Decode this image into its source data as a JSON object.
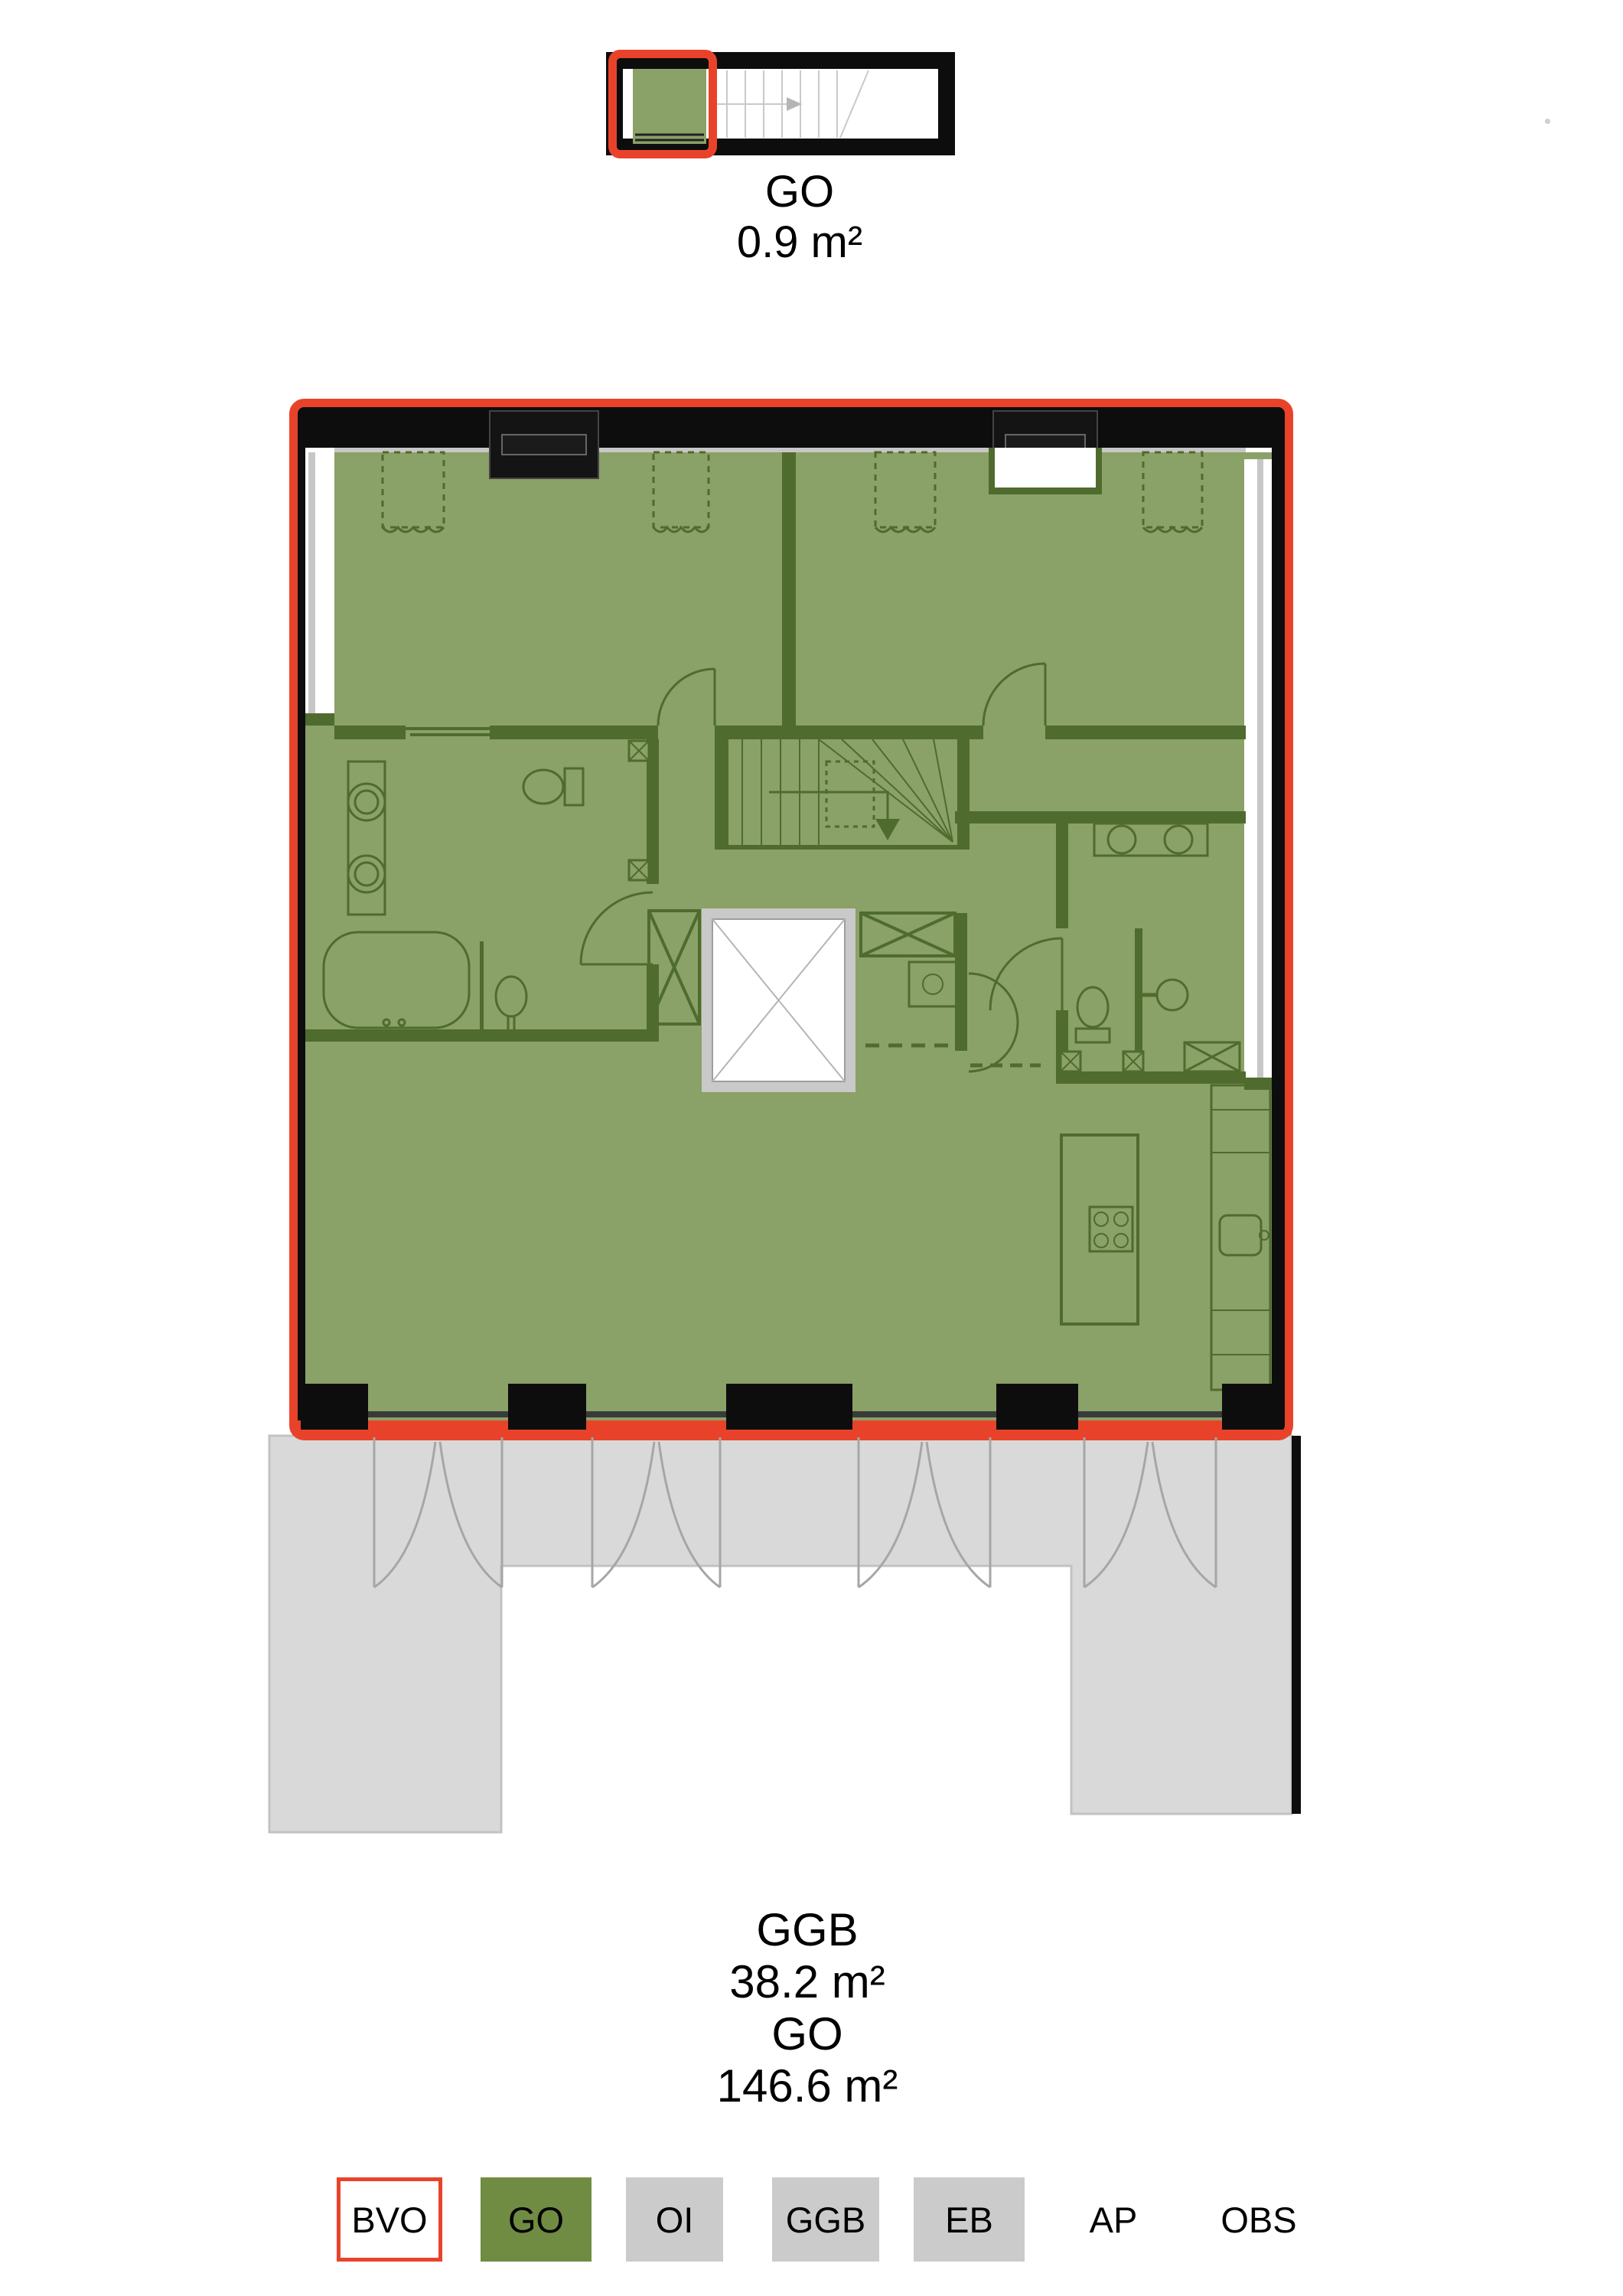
{
  "document": {
    "type": "apartment floor plan sheet",
    "background": "#ffffff"
  },
  "upper_plan": {
    "label": "GO",
    "area": "0.9 m²"
  },
  "main_plan": {
    "ggb_label": "GGB",
    "ggb_area": "38.2 m²",
    "go_label": "GO",
    "go_area": "146.6 m²"
  },
  "legend": {
    "items": [
      {
        "label": "BVO",
        "fill": "#ffffff",
        "border": "#e8432a"
      },
      {
        "label": "GO",
        "fill": "#6f8c42"
      },
      {
        "label": "OI",
        "fill": "#cbcbcb"
      },
      {
        "label": "GGB",
        "fill": "#cbcbcb"
      },
      {
        "label": "EB",
        "fill": "#cbcbcb"
      },
      {
        "label": "AP",
        "fill": "transparent"
      },
      {
        "label": "OBS",
        "fill": "transparent"
      }
    ]
  },
  "colors": {
    "bvo_outline_red": "#e8432a",
    "go_overlay_green": "#8aa167",
    "go_legend_green": "#6f8c42",
    "wall_black": "#0d0d0d",
    "interior_wall_green": "#4f6b2d",
    "ggb_terrace_gray": "#d9d9d9",
    "legend_gray": "#cbcbcb"
  }
}
